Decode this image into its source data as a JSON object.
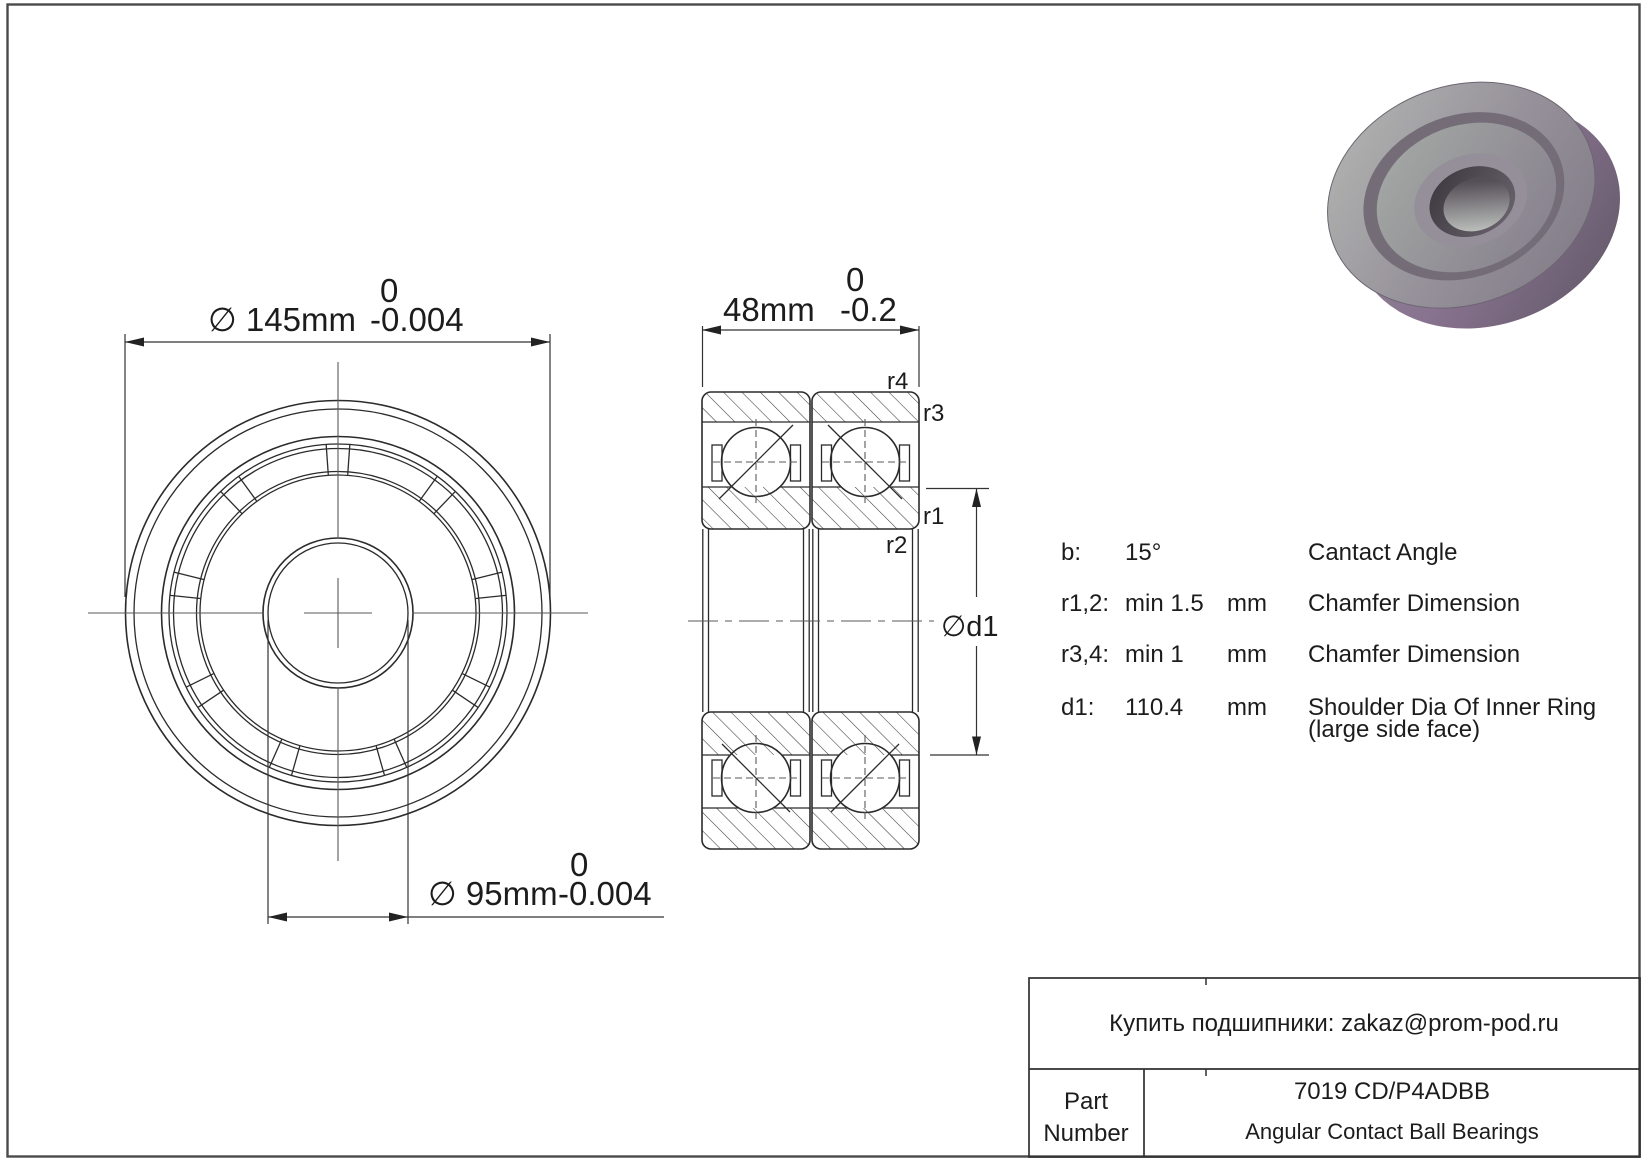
{
  "page": {
    "bg": "#ffffff",
    "frame_color": "#4a4a4a",
    "line_color": "#2b2b2b"
  },
  "front_view": {
    "od_dim": {
      "prefix": "∅ 145mm",
      "tol_upper": "0",
      "tol_lower": "-0.004"
    },
    "bore_dim": {
      "prefix": "∅ 95mm",
      "tol_upper": "0",
      "tol_lower": "-0.004"
    }
  },
  "section_view": {
    "width_dim": {
      "prefix": "48mm",
      "tol_upper": "0",
      "tol_lower": "-0.2"
    },
    "d1_label": "∅d1",
    "chamfer_labels": {
      "r4": "r4",
      "r3": "r3",
      "r1": "r1",
      "r2": "r2"
    }
  },
  "specs": {
    "rows": [
      {
        "key": "b:",
        "value": "15°",
        "unit": "",
        "desc": "Cantact Angle",
        "desc2": ""
      },
      {
        "key": "r1,2:",
        "value": "min 1.5",
        "unit": "mm",
        "desc": "Chamfer Dimension",
        "desc2": ""
      },
      {
        "key": "r3,4:",
        "value": "min 1",
        "unit": "mm",
        "desc": "Chamfer Dimension",
        "desc2": ""
      },
      {
        "key": "d1:",
        "value": "110.4",
        "unit": "mm",
        "desc": "Shoulder Dia Of Inner Ring",
        "desc2": "(large side face)"
      }
    ]
  },
  "title_block": {
    "contact": "Купить подшипники: zakaz@prom-pod.ru",
    "part_label_1": "Part",
    "part_label_2": "Number",
    "part_number": "7019 CD/P4ADBB",
    "part_type": "Angular Contact Ball Bearings"
  }
}
